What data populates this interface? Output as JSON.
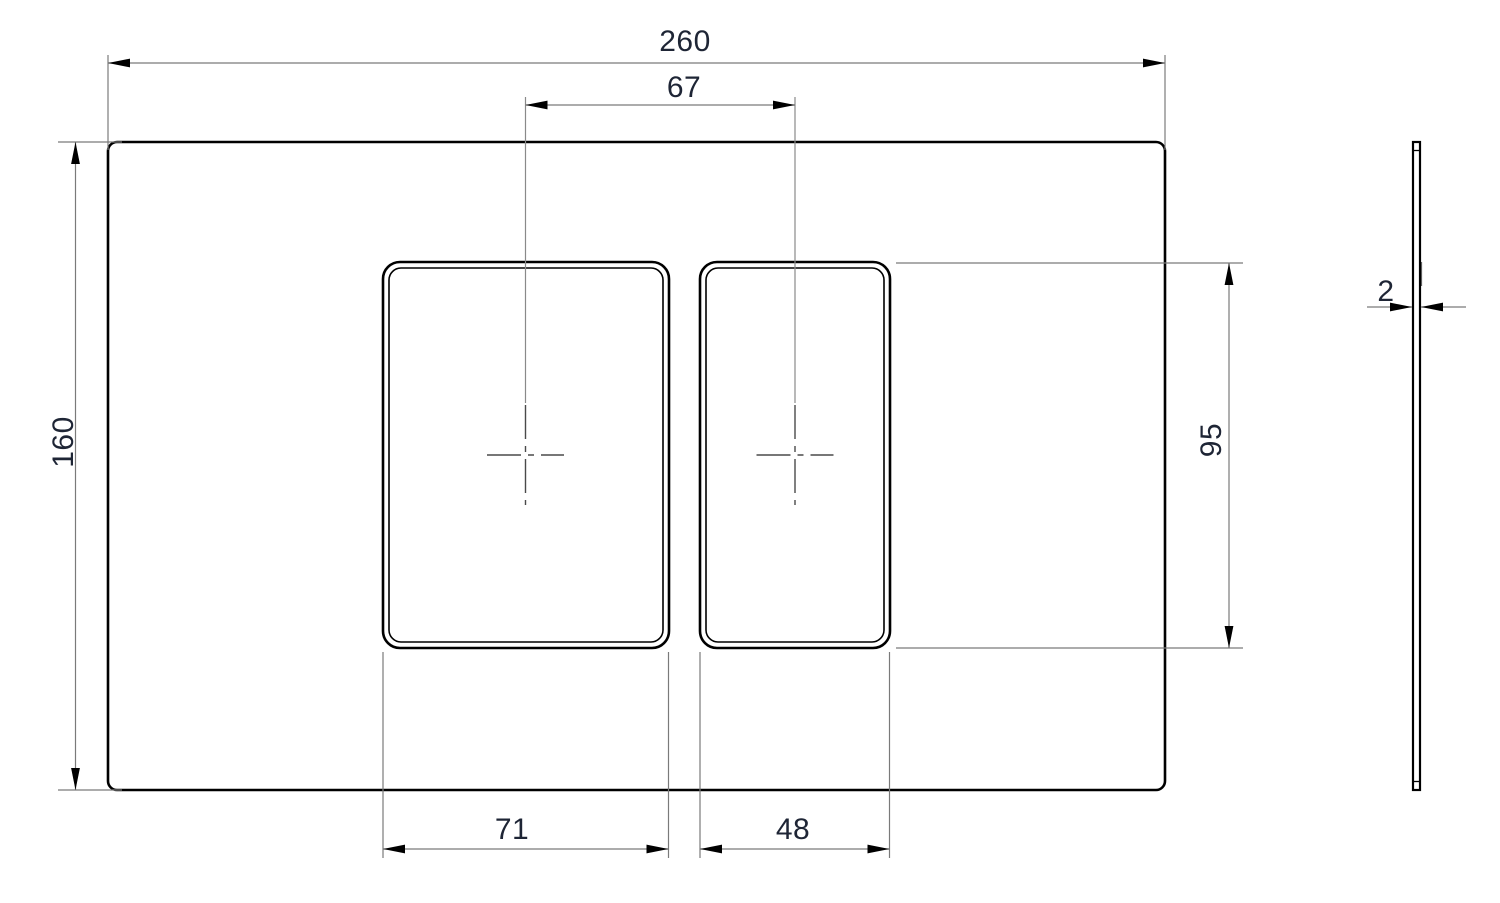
{
  "drawing": {
    "type": "engineering-drawing",
    "views": {
      "front": {
        "name": "front-view-flush-plate",
        "dimensions": {
          "overall_width": "260",
          "slot_center_spacing": "67",
          "overall_height": "160",
          "slot_height": "95",
          "left_slot_width": "71",
          "right_slot_width": "48"
        }
      },
      "side": {
        "name": "side-profile-view",
        "dimensions": {
          "thickness": "2"
        }
      }
    },
    "colors": {
      "model_edge": "#000000",
      "dimension_line": "#7a7a7a",
      "dimension_text": "#1e2535",
      "background": "#ffffff"
    }
  }
}
